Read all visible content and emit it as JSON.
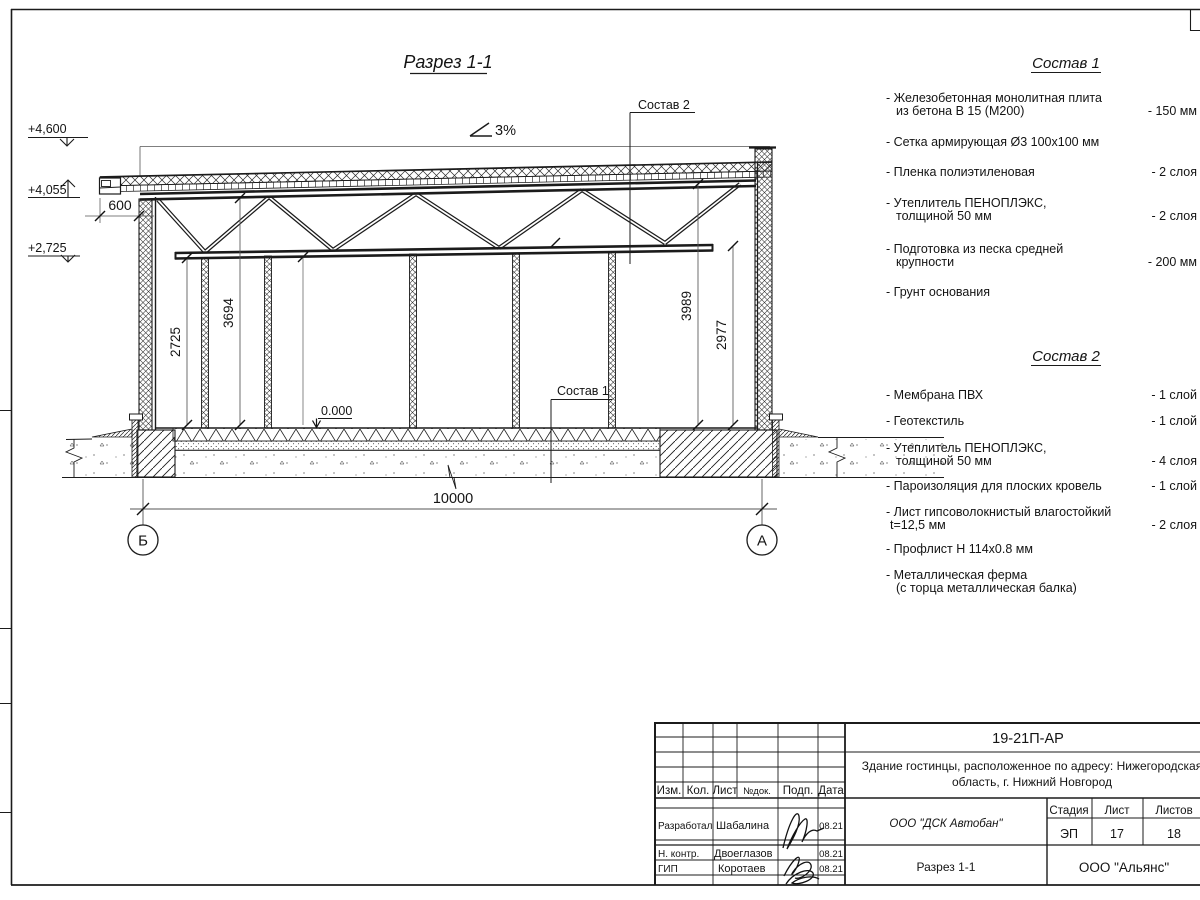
{
  "drawing": {
    "title": "Разрез 1-1",
    "slope": "3%",
    "elev_parapet": "+4,600",
    "elev_eaves": "+4,055",
    "elev_truss": "+2,725",
    "elev_floor": "0.000",
    "dim_overhang": "600",
    "dim_h_left_wall": "2725",
    "dim_h_left_top": "3694",
    "dim_h_right_top": "3989",
    "dim_h_right_bottom": "2977",
    "dim_span": "10000",
    "axis_left": "Б",
    "axis_right": "А",
    "callout_roof": "Состав 2",
    "callout_floor": "Состав 1"
  },
  "sostav1": {
    "title": "Состав 1",
    "items": [
      {
        "line1": "- Железобетонная  монолитная плита",
        "line2": "из бетона В 15 (М200)",
        "value": "- 150 мм"
      },
      {
        "line1": "- Сетка армирующая Ø3 100х100 мм",
        "line2": "",
        "value": ""
      },
      {
        "line1": "- Пленка полиэтиленовая",
        "line2": "",
        "value": "- 2 слоя"
      },
      {
        "line1": "- Утеплитель ПЕНОПЛЭКС,",
        "line2": "толщиной 50 мм",
        "value": "- 2 слоя"
      },
      {
        "line1": "- Подготовка из песка средней",
        "line2": "крупности",
        "value": "- 200 мм"
      },
      {
        "line1": "- Грунт основания",
        "line2": "",
        "value": ""
      }
    ]
  },
  "sostav2": {
    "title": "Состав 2",
    "items": [
      {
        "line1": "- Мембрана ПВХ",
        "line2": "",
        "value": "- 1 слой"
      },
      {
        "line1": "- Геотекстиль",
        "line2": "",
        "value": "- 1 слой"
      },
      {
        "line1": "- Утеплитель ПЕНОПЛЭКС,",
        "line2": "толщиной 50 мм",
        "value": "- 4 слоя"
      },
      {
        "line1": "- Пароизоляция для плоских кровель",
        "line2": "",
        "value": "- 1 слой"
      },
      {
        "line1": "- Лист гипсоволокнистый влагостойкий",
        "line2": "t=12,5 мм",
        "value": "- 2 слоя"
      },
      {
        "line1": "- Профлист Н 114х0.8 мм",
        "line2": "",
        "value": ""
      },
      {
        "line1": "- Металлическая ферма",
        "line2": "(с торца металлическая балка)",
        "value": ""
      }
    ]
  },
  "titleblock": {
    "doc_code": "19-21П-АР",
    "project_line1": "Здание гостинцы, расположенное по адресу: Нижегородская",
    "project_line2": "область, г. Нижний Новгород",
    "organization": "ООО \"ДСК Автобан\"",
    "sheet_name": "Разрез 1-1",
    "contractor": "ООО \"Альянс\"",
    "col_izm": "Изм.",
    "col_kol": "Кол.",
    "col_list": "Лист",
    "col_ndok": "№док.",
    "col_podp": "Подп.",
    "col_data": "Дата",
    "h_stage": "Стадия",
    "h_sheet": "Лист",
    "h_sheets": "Листов",
    "stage": "ЭП",
    "sheet_no": "17",
    "sheets_total": "18",
    "row1_role": "Разработал",
    "row1_name": "Шабалина",
    "row1_date": "08.21",
    "row2_role": "Н. контр.",
    "row2_name": "Двоеглазов",
    "row2_date": "08.21",
    "row3_role": "ГИП",
    "row3_name": "Коротаев",
    "row3_date": "08.21"
  }
}
